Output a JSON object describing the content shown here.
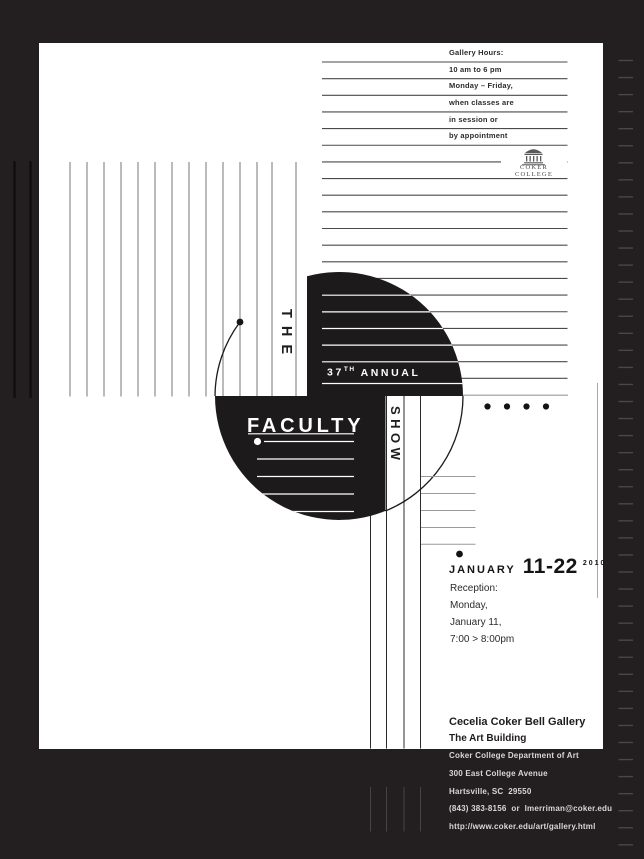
{
  "poster": {
    "gallery_hours": "Gallery Hours:\n10 am to 6 pm\nMonday – Friday,\nwhen classes are\nin session or\nby appointment",
    "wordmark": "COKER COLLEGE",
    "title": {
      "the": "THE",
      "num": "37",
      "sup": "TH",
      "annual": "ANNUAL",
      "faculty": "FACULTY",
      "show": "SHOW"
    },
    "date": {
      "month": "JANUARY",
      "days": "11-22",
      "year": "2010"
    },
    "reception": "Reception:\nMonday,\nJanuary 11,\n7:00 > 8:00pm",
    "venue": {
      "name": "Cecelia Coker Bell Gallery",
      "building": "The Art Building"
    },
    "footer": "Coker College Department of Art\n300 East College Avenue\nHartsville, SC  29550\n(843) 383-8156  or  lmerriman@coker.edu\nhttp://www.coker.edu/art/gallery.html",
    "colors": {
      "background": "#231f20",
      "ink": "#1c1a1b",
      "paper": "#ffffff"
    }
  }
}
